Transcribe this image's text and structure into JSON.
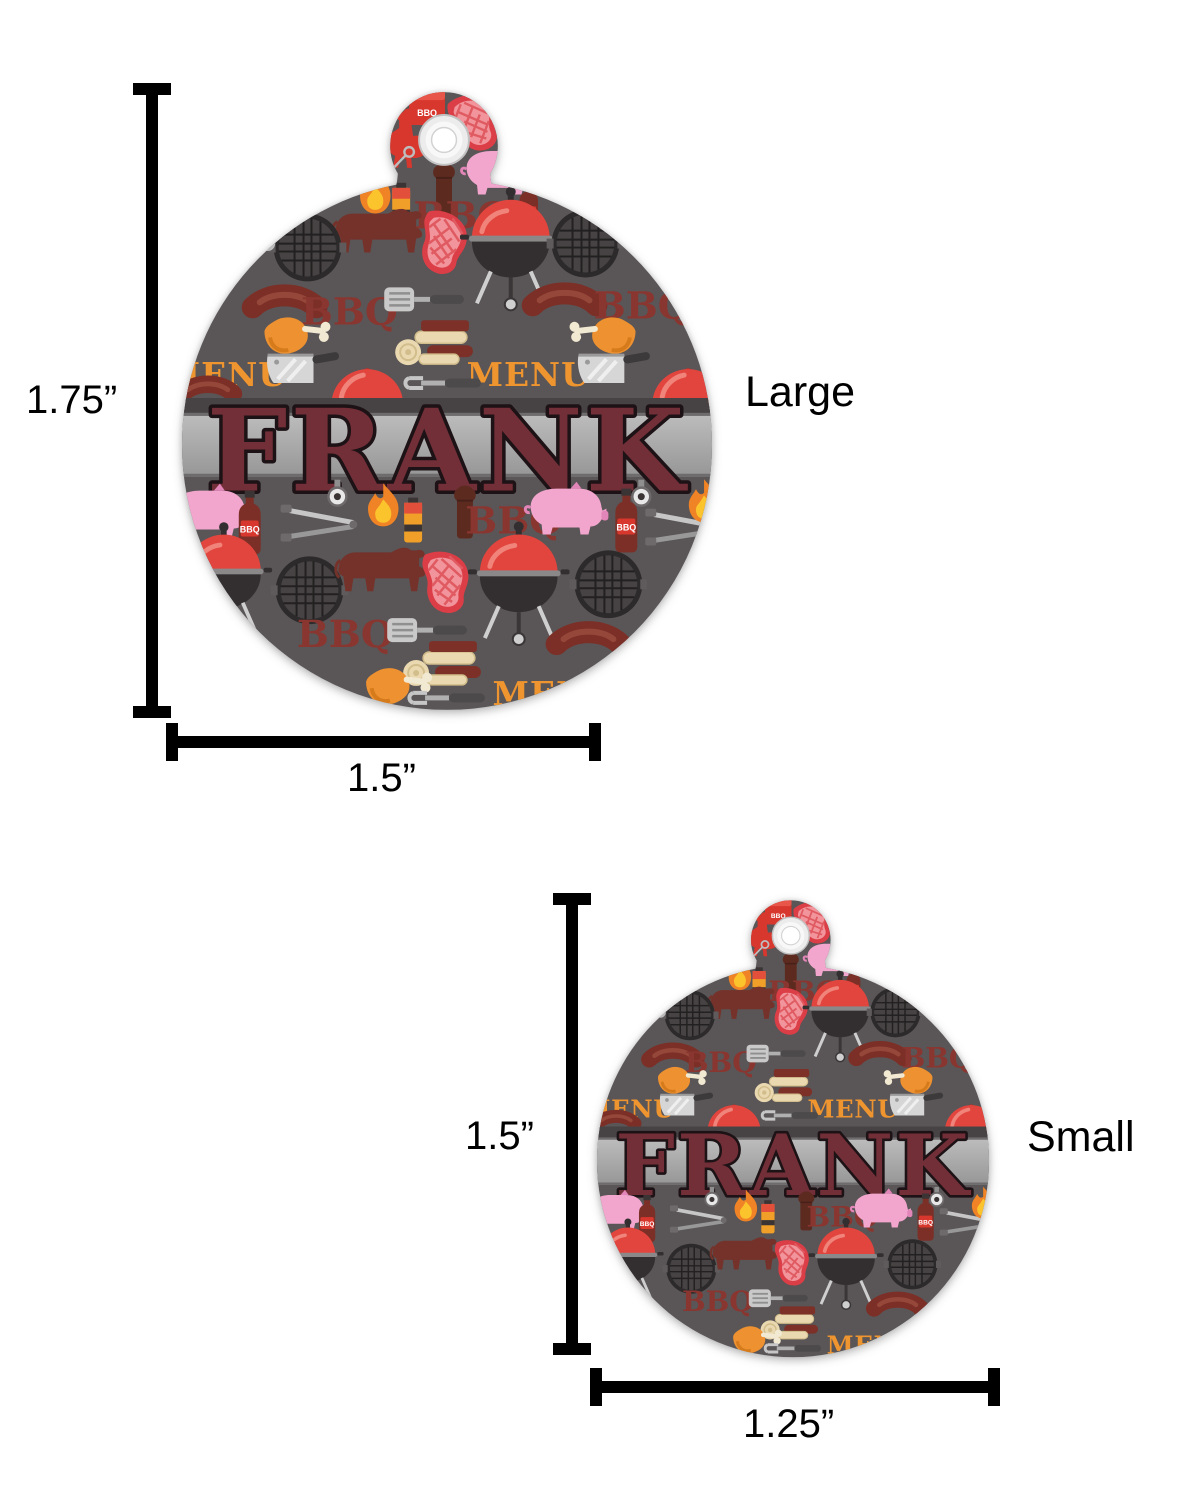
{
  "design": {
    "pet_name": "FRANK",
    "words": {
      "bbq": "BBQ",
      "menu": "MENU"
    },
    "colors": {
      "tag_background": "#5a5556",
      "banner_light": "#a9a9a9",
      "banner_dark_strip": "#474344",
      "name_fill": "#722f38",
      "name_outline": "#1d1215",
      "bbq_word": "#8a3630",
      "menu_word": "#ef9530",
      "grill_red": "#e2453e",
      "pig_pink": "#f2a6ce",
      "drumstick_orange": "#ee9130",
      "dimension_line": "#000000"
    }
  },
  "sizes": {
    "large": {
      "label": "Large",
      "height_label": "1.75”",
      "width_label": "1.5”"
    },
    "small": {
      "label": "Small",
      "height_label": "1.5”",
      "width_label": "1.25”"
    }
  }
}
